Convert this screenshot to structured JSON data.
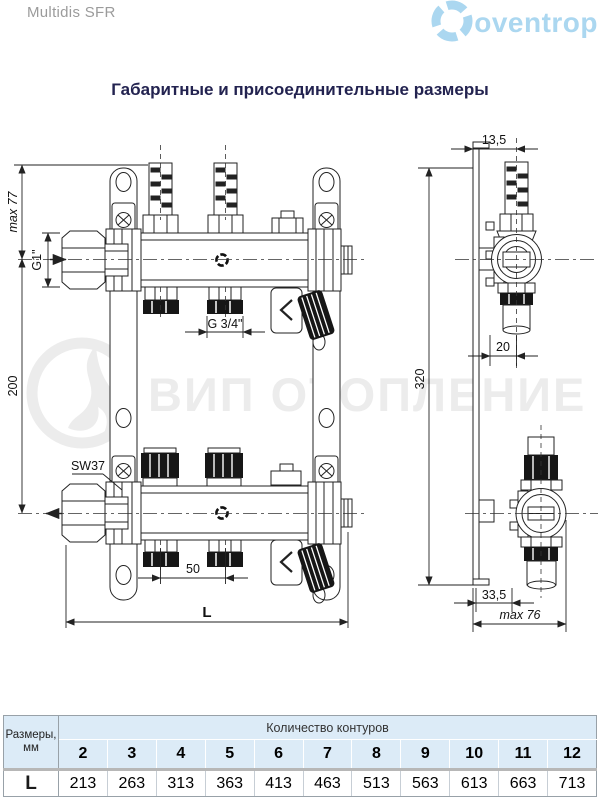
{
  "header": {
    "product_name": "Multidis SFR",
    "brand_name": "oventrop"
  },
  "page_title": "Габаритные и присоединительные размеры",
  "watermark_text": "ВИП ОТОПЛЕНИЕ",
  "drawing": {
    "labels": {
      "max_height": "max 77",
      "supply_thread": "G1\"",
      "axis_distance": "200",
      "wrench_size": "SW37",
      "outlet_thread": "G 3/4\"",
      "outlet_spacing": "50",
      "total_length": "L",
      "bracket_offset": "13,5",
      "mount_height": "320",
      "top_depth": "20",
      "bottom_depth": "33,5",
      "max_depth": "max 76"
    }
  },
  "table": {
    "corner_label_line1": "Размеры,",
    "corner_label_line2": "мм",
    "group_header": "Количество контуров",
    "columns": [
      "2",
      "3",
      "4",
      "5",
      "6",
      "7",
      "8",
      "9",
      "10",
      "11",
      "12"
    ],
    "row_label": "L",
    "values": [
      "213",
      "263",
      "313",
      "363",
      "413",
      "463",
      "513",
      "563",
      "613",
      "663",
      "713"
    ]
  },
  "colors": {
    "brand_blue": "#abd7f0",
    "table_header_bg": "#dcebf7",
    "title_color": "#232350",
    "watermark_gray": "#ececec"
  }
}
